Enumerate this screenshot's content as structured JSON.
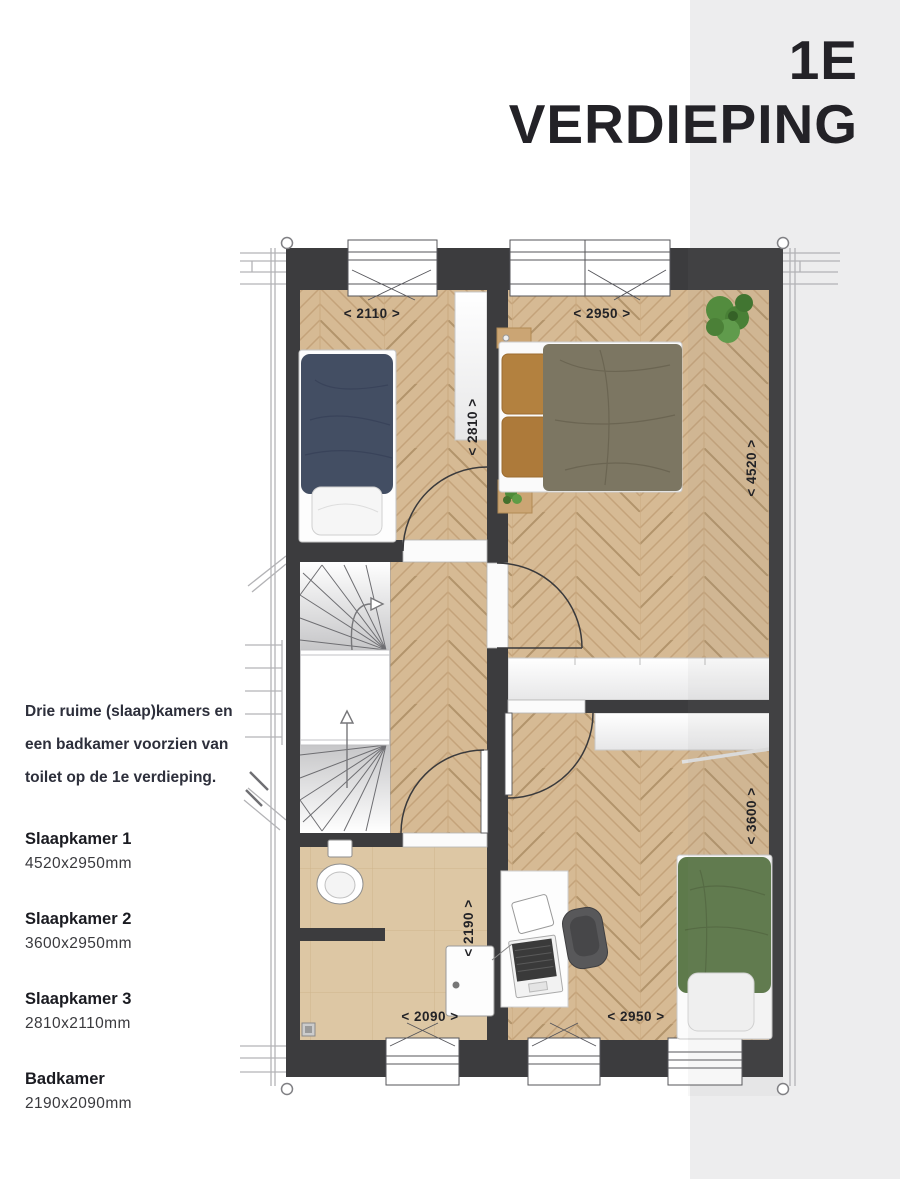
{
  "header": {
    "title_line1": "1E",
    "title_line2": "VERDIEPING"
  },
  "description": {
    "line1": "Drie ruime (slaap)kamers en",
    "line2": "een badkamer voorzien van",
    "line3": "toilet op de 1e verdieping."
  },
  "rooms": [
    {
      "name": "Slaapkamer 1",
      "size": "4520x2950mm"
    },
    {
      "name": "Slaapkamer 2",
      "size": "3600x2950mm"
    },
    {
      "name": "Slaapkamer 3",
      "size": "2810x2110mm"
    },
    {
      "name": "Badkamer",
      "size": "2190x2090mm"
    }
  ],
  "plan": {
    "dims": {
      "bedroom3_width": "< 2110 >",
      "bedroom1_width": "< 2950 >",
      "bedroom3_depth": "< 2810 >",
      "bedroom1_depth": "< 4520 >",
      "bedroom2_depth": "< 3600 >",
      "bathroom_depth": "< 2190 >",
      "bathroom_width": "< 2090 >",
      "bedroom2_width": "< 2950 >"
    },
    "colors": {
      "accent_band": "#ededee",
      "wall": "#3c3c3e",
      "wood_floor": "#d6ba94",
      "bathroom_tile": "#ddc7a4",
      "bed_blue": "#434e63",
      "bed_olive": "#7c7662",
      "bed_green": "#5e7a4b",
      "pillow_orange": "#b3813f",
      "plant_green": "#4f8c39"
    }
  }
}
